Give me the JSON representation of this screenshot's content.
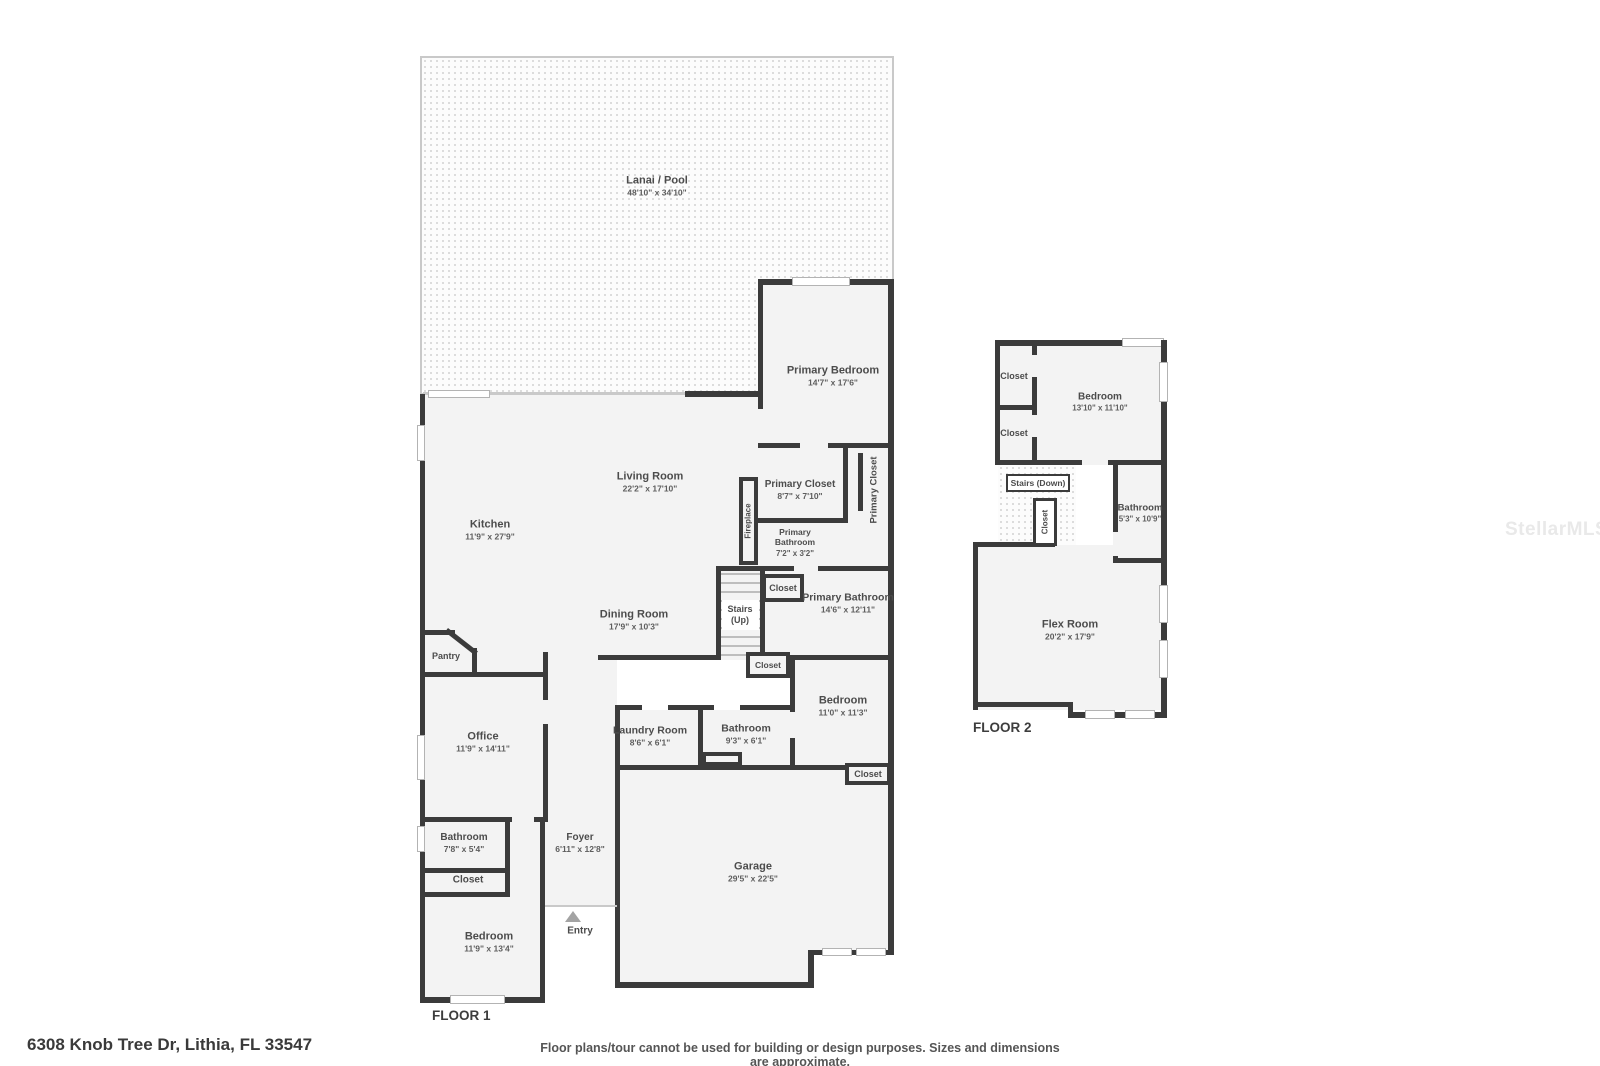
{
  "floor1": {
    "label": "FLOOR 1",
    "rooms": {
      "lanai": {
        "name": "Lanai / Pool",
        "dims": "48'10\" x 34'10\""
      },
      "primary_bedroom": {
        "name": "Primary Bedroom",
        "dims": "14'7\" x 17'6\""
      },
      "living_room": {
        "name": "Living Room",
        "dims": "22'2\" x 17'10\""
      },
      "kitchen": {
        "name": "Kitchen",
        "dims": "11'9\" x 27'9\""
      },
      "dining_room": {
        "name": "Dining Room",
        "dims": "17'9\" x 10'3\""
      },
      "pantry": {
        "name": "Pantry"
      },
      "fireplace": {
        "name": "Fireplace"
      },
      "primary_closet": {
        "name": "Primary Closet",
        "dims": "8'7\" x 7'10\""
      },
      "primary_closet_side": {
        "name": "Primary Closet"
      },
      "primary_bathroom_small": {
        "name": "Primary Bathroom",
        "dims": "7'2\" x 3'2\""
      },
      "primary_bathroom": {
        "name": "Primary Bathroom",
        "dims": "14'6\" x 12'11\""
      },
      "stairs_up": {
        "name": "Stairs (Up)"
      },
      "closet_hall": {
        "name": "Closet"
      },
      "closet_stairs": {
        "name": "Closet"
      },
      "bedroom_2": {
        "name": "Bedroom",
        "dims": "11'0\" x 11'3\""
      },
      "laundry_room": {
        "name": "Laundry Room",
        "dims": "8'6\" x 6'1\""
      },
      "bathroom_2": {
        "name": "Bathroom",
        "dims": "9'3\" x 6'1\""
      },
      "closet_garage": {
        "name": "Closet"
      },
      "garage": {
        "name": "Garage",
        "dims": "29'5\" x 22'5\""
      },
      "office": {
        "name": "Office",
        "dims": "11'9\" x 14'11\""
      },
      "bathroom_3": {
        "name": "Bathroom",
        "dims": "7'8\" x 5'4\""
      },
      "closet_bedroom": {
        "name": "Closet"
      },
      "bedroom_3": {
        "name": "Bedroom",
        "dims": "11'9\" x 13'4\""
      },
      "foyer": {
        "name": "Foyer",
        "dims": "6'11\" x 12'8\""
      },
      "entry": {
        "name": "Entry"
      }
    }
  },
  "floor2": {
    "label": "FLOOR 2",
    "rooms": {
      "closet_top": {
        "name": "Closet"
      },
      "closet_mid": {
        "name": "Closet"
      },
      "bedroom": {
        "name": "Bedroom",
        "dims": "13'10\" x 11'10\""
      },
      "stairs_down": {
        "name": "Stairs (Down)"
      },
      "closet_stairs": {
        "name": "Closet"
      },
      "bathroom": {
        "name": "Bathroom",
        "dims": "5'3\" x 10'9\""
      },
      "flex_room": {
        "name": "Flex Room",
        "dims": "20'2\" x 17'9\""
      }
    }
  },
  "footer": {
    "address": "6308 Knob Tree Dr, Lithia, FL 33547",
    "disclaimer": "Floor plans/tour cannot be used for building or design purposes. Sizes and dimensions are approximate."
  },
  "watermark": "StellarMLS",
  "colors": {
    "wall": "#3b3b3b",
    "room_fill": "#f3f3f3",
    "lanai_border": "#c9c9c9",
    "text": "#4c4c4c"
  }
}
